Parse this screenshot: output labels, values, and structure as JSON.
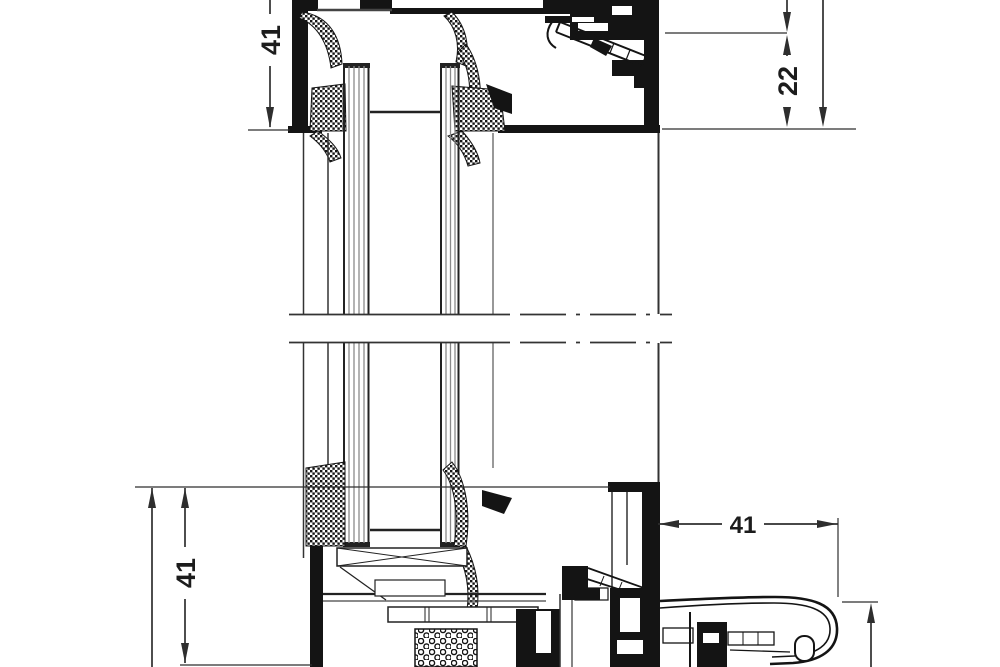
{
  "drawing": {
    "kind": "window-profile-cross-section",
    "background_color": "#ffffff",
    "line_color": "#141414",
    "dimension_line_color": "#2e2e2e",
    "glass_line_color": "#8a8a8a",
    "dimensions": {
      "head_frame_depth": {
        "value": "41",
        "orientation": "vertical",
        "location": "top-left"
      },
      "head_glass_inset": {
        "value": "22",
        "orientation": "vertical",
        "location": "top-right"
      },
      "sill_frame_depth": {
        "value": "41",
        "orientation": "vertical",
        "location": "bottom-left"
      },
      "sill_projection": {
        "value": "41",
        "orientation": "horizontal",
        "location": "bottom-right"
      }
    }
  }
}
